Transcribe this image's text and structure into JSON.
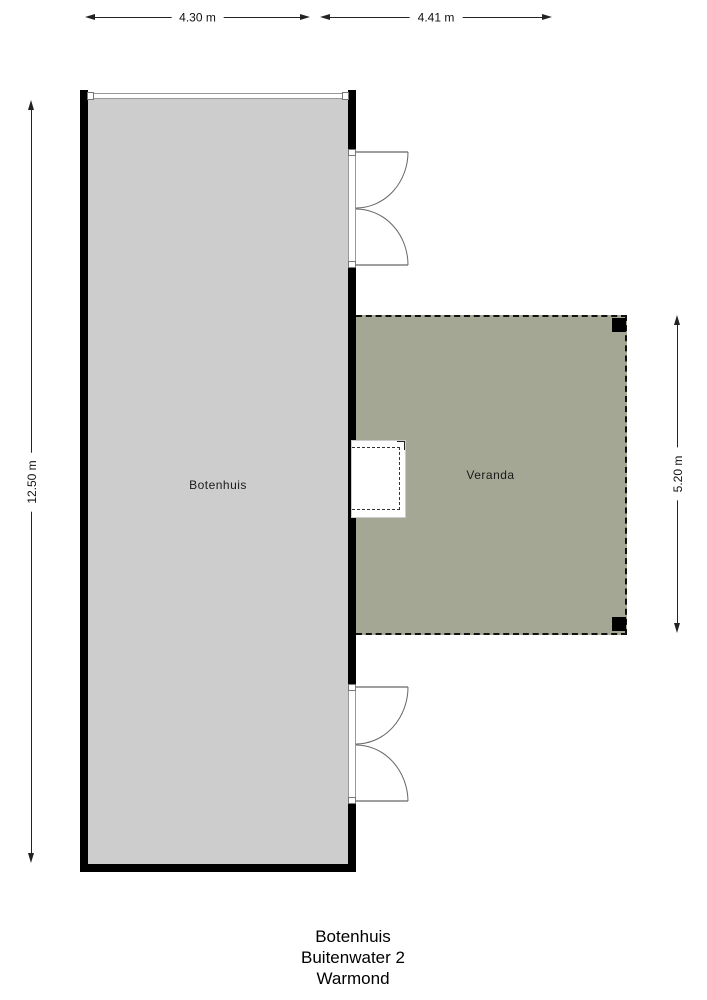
{
  "plan": {
    "building_label": "Botenhuis",
    "veranda_label": "Veranda"
  },
  "dimensions": {
    "top_left": "4.30 m",
    "top_right": "4.41 m",
    "left": "12.50 m",
    "right": "5.20 m"
  },
  "title": {
    "line1": "Botenhuis",
    "line2": "Buitenwater 2",
    "line3": "Warmond"
  },
  "colors": {
    "building_fill": "#cdcdcd",
    "veranda_fill": "#a5a795",
    "wall": "#000000",
    "dimension_line": "#222222"
  }
}
